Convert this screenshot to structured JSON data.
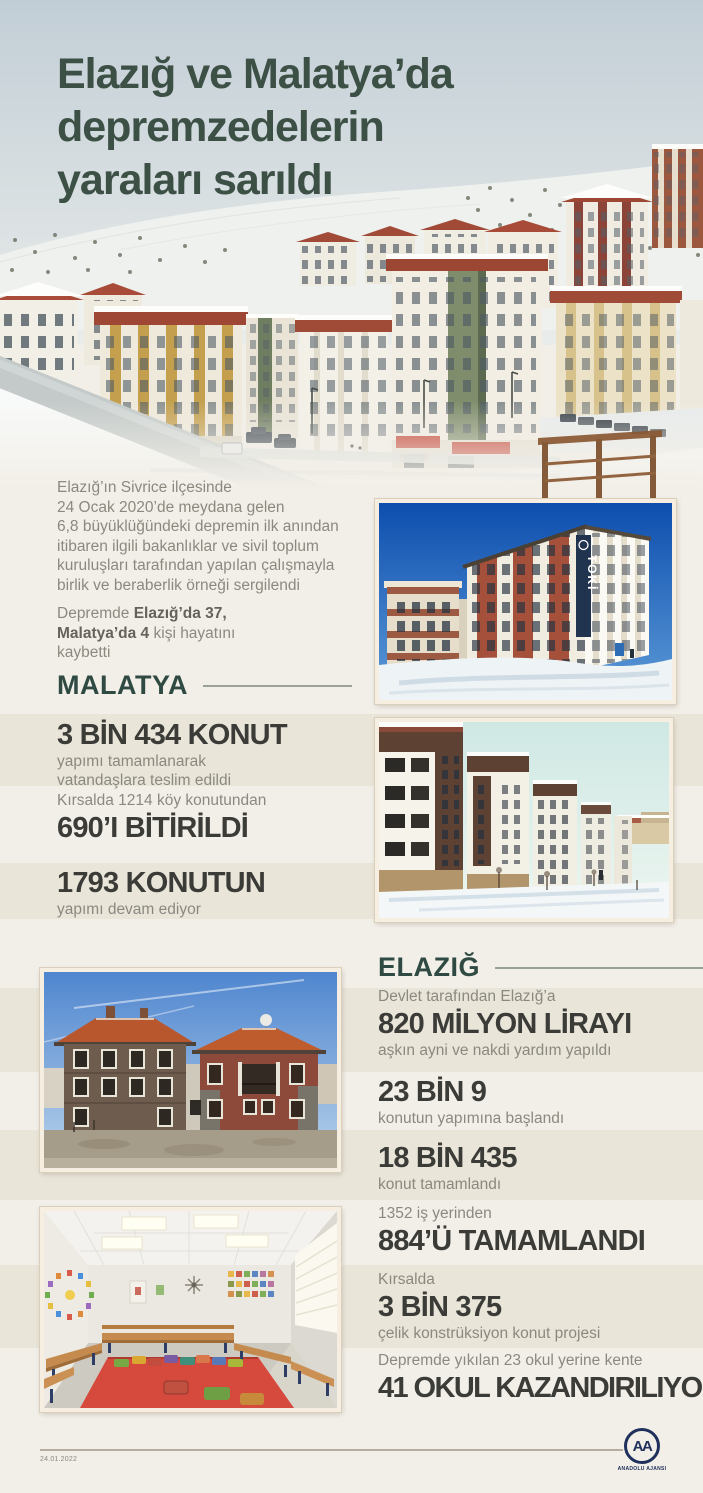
{
  "colors": {
    "title_green": "#3d5046",
    "heading_green": "#2f4a42",
    "stat_charcoal": "#3b3b38",
    "body_gray": "#8b897f",
    "logo_navy": "#20305c",
    "page_background": "#f2efe8",
    "band_beige": "#e9e5d9"
  },
  "header": {
    "title": "Elazığ ve Malatya’da\ndepremzedelerin\nyaraları sarıldı"
  },
  "intro": {
    "text": "Elazığ’ın Sivrice ilçesinde\n24 Ocak 2020’de meydana gelen\n6,8 büyüklüğündeki depremin ilk anından\nitibaren ilgili bakanlıklar ve sivil toplum\nkuruluşları tarafından yapılan çalışmayla\nbirlik ve beraberlik örneği sergilendi"
  },
  "casualties": {
    "segments": [
      {
        "text": "Depremde ",
        "bold": false
      },
      {
        "text": "Elazığ’da 37,",
        "bold": true,
        "break_after": true
      },
      {
        "text": "Malatya’da 4",
        "bold": true
      },
      {
        "text": " kişi hayatını",
        "bold": false,
        "break_after": true
      },
      {
        "text": "kaybetti",
        "bold": false
      }
    ]
  },
  "malatya": {
    "heading": "MALATYA",
    "stats": [
      {
        "value": "3 BİN 434 KONUT",
        "sub": "yapımı tamamlanarak\nvatandaşlara teslim edildi"
      },
      {
        "pre": "Kırsalda 1214 köy konutundan",
        "value": "690’I BİTİRİLDİ"
      },
      {
        "value": "1793 KONUTUN",
        "sub": "yapımı devam ediyor"
      }
    ]
  },
  "elazig": {
    "heading": "ELAZIĞ",
    "stats": [
      {
        "pre": "Devlet tarafından Elazığ’a",
        "value": "820 MİLYON LİRAYI",
        "sub": "aşkın ayni ve nakdi yardım yapıldı"
      },
      {
        "value": "23 BİN 9",
        "sub": "konutun yapımına başlandı"
      },
      {
        "value": "18 BİN 435",
        "sub": "konut tamamlandı"
      },
      {
        "pre": "1352 iş yerinden",
        "value": "884’Ü TAMAMLANDI"
      },
      {
        "pre": "Kırsalda",
        "value": "3 BİN 375",
        "sub": "çelik konstrüksiyon konut projesi"
      },
      {
        "pre": "Depremde yıkılan 23 okul yerine kente",
        "value": "41 OKUL KAZANDIRILIYOR"
      }
    ]
  },
  "photos": {
    "toki_sign": "TOKİ"
  },
  "footer": {
    "date": "24.01.2022",
    "logo_text": "AA",
    "agency": "ANADOLU AJANSI"
  }
}
